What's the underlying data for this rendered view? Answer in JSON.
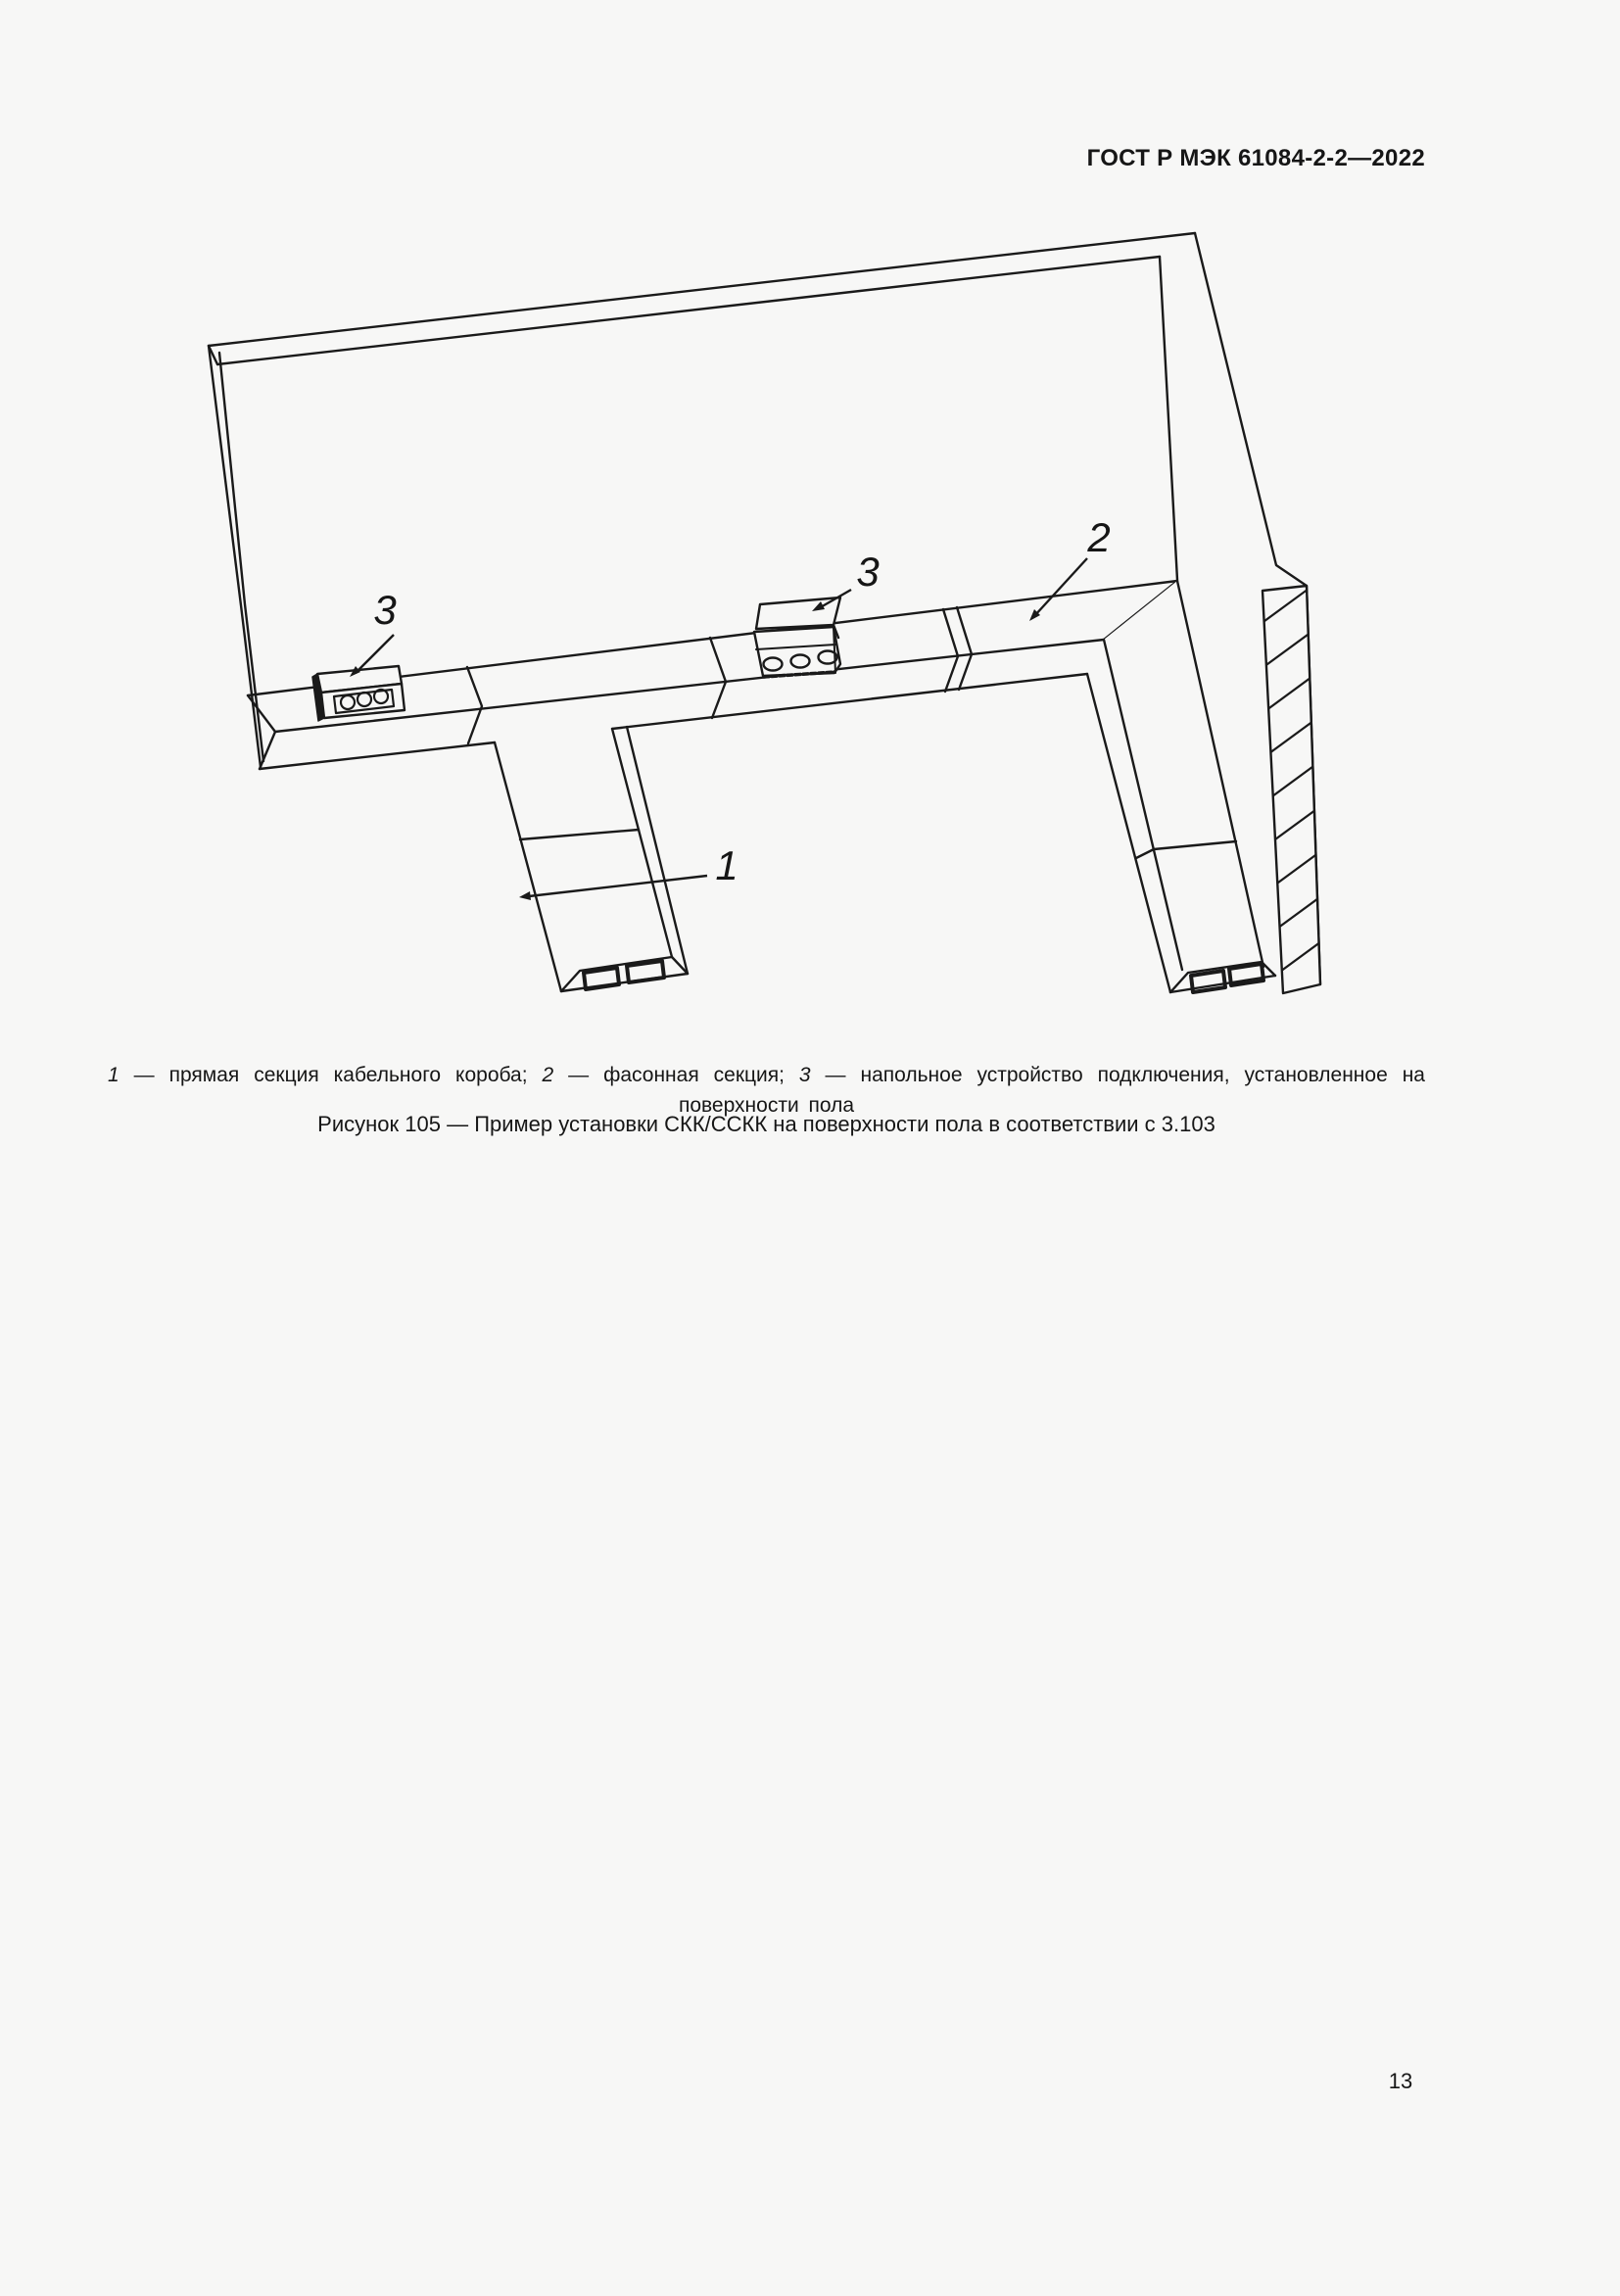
{
  "header": {
    "title": "ГОСТ Р МЭК 61084-2-2—2022"
  },
  "figure": {
    "callouts": [
      "3",
      "3",
      "2",
      "1"
    ]
  },
  "legend": {
    "items": [
      {
        "num": "1",
        "text": " — прямая секция кабельного короба; "
      },
      {
        "num": "2",
        "text": " — фасонная секция; "
      },
      {
        "num": "3",
        "text": " — напольное устройство подключения, установленное на поверхности пола"
      }
    ]
  },
  "caption": {
    "text": "Рисунок 105 — Пример установки СКК/ССКК на поверхности пола в соответствии с 3.103"
  },
  "footer": {
    "page_number": "13"
  }
}
